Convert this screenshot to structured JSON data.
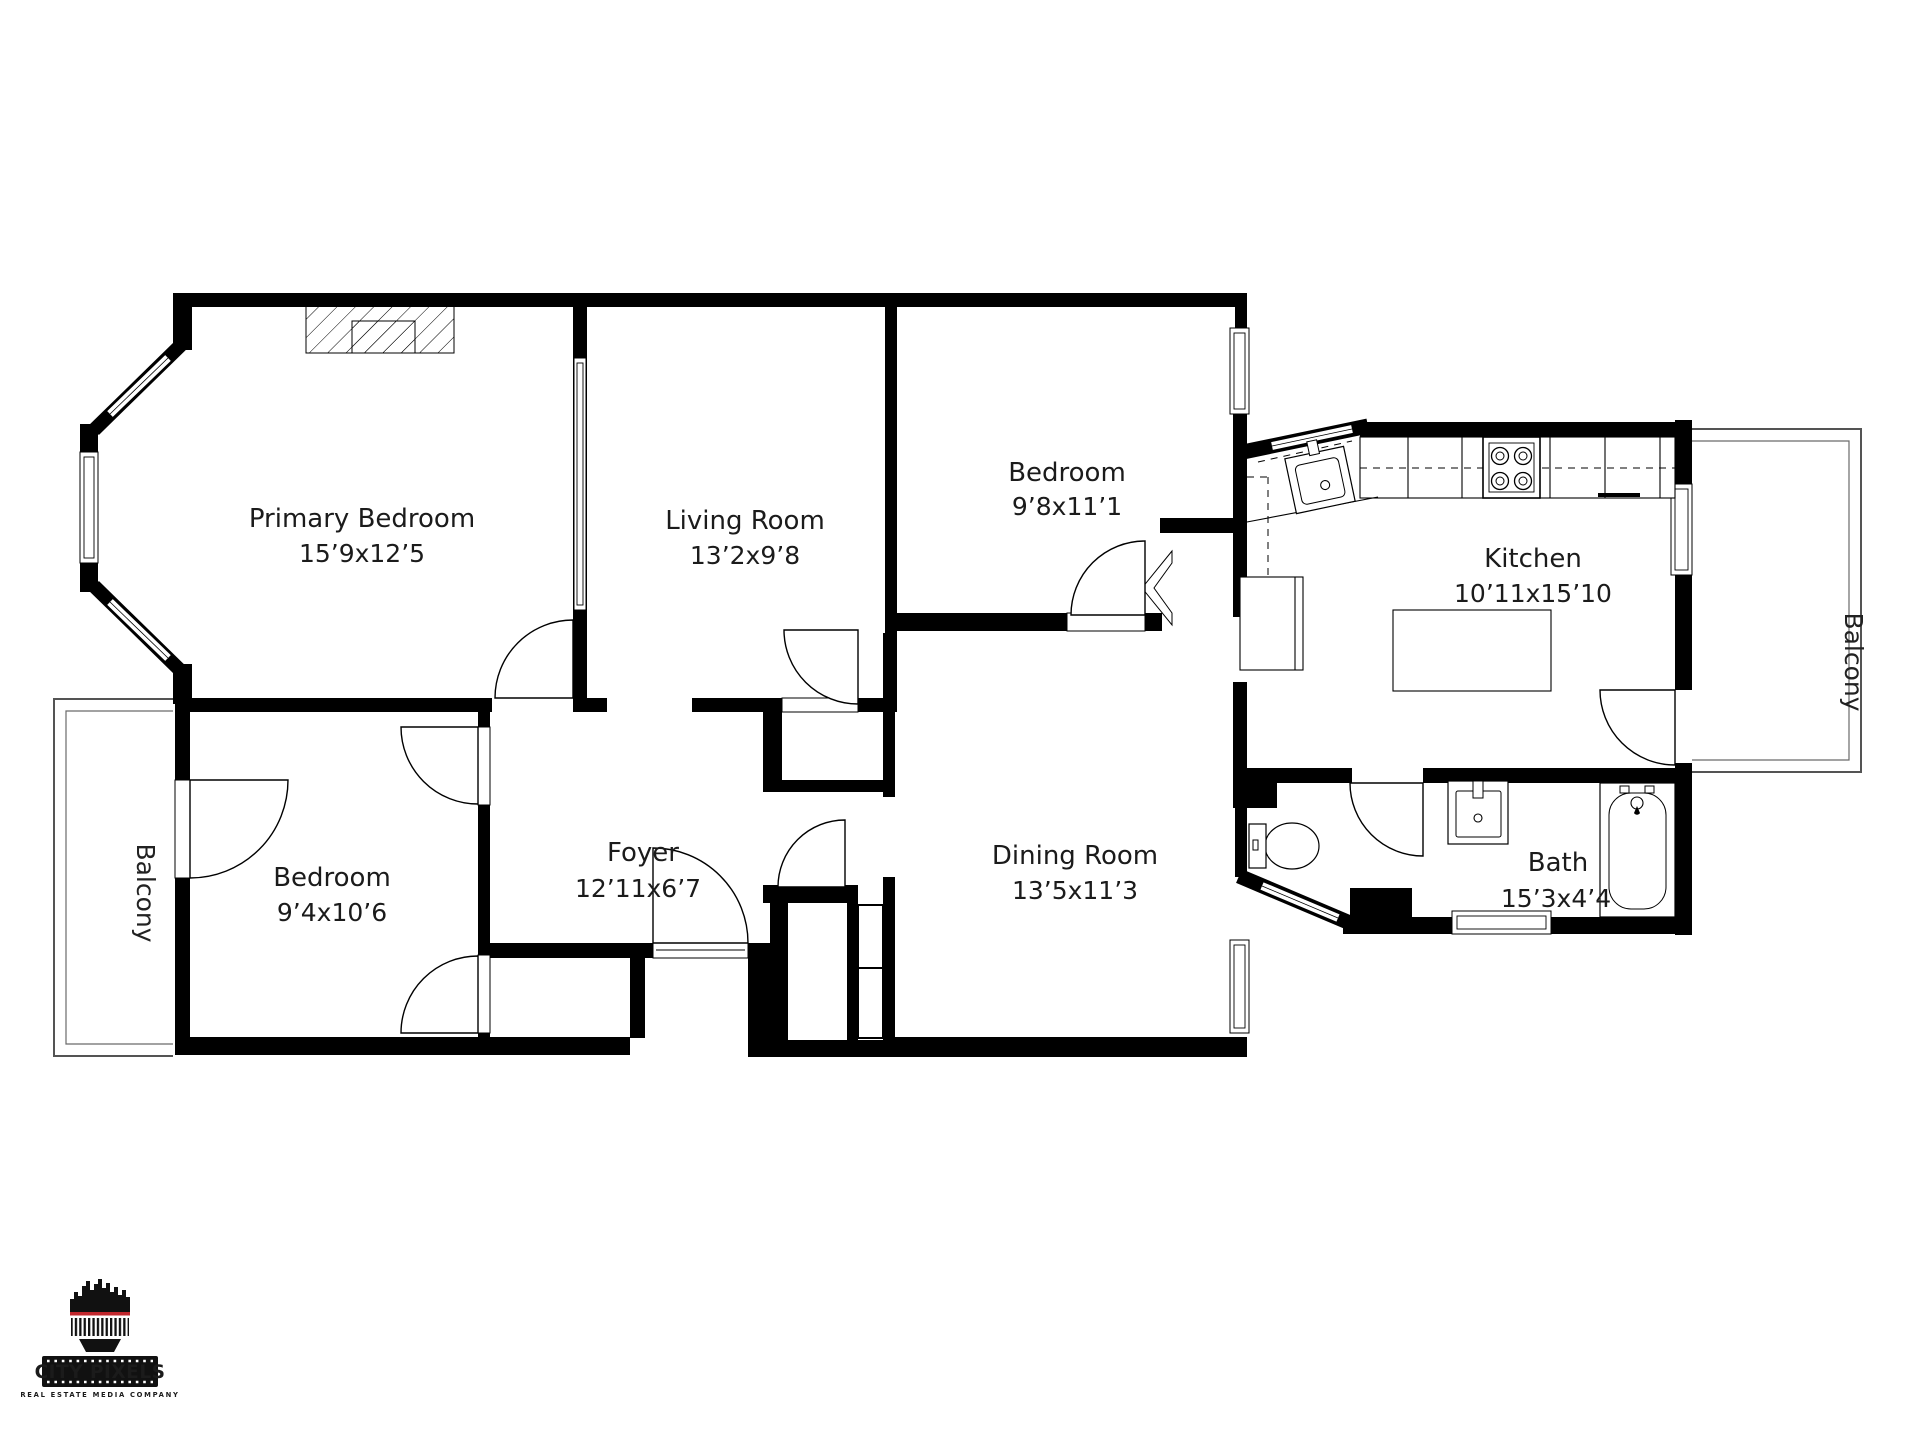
{
  "plan": {
    "rooms": [
      {
        "name": "Primary Bedroom",
        "dims": "15’9x12’5"
      },
      {
        "name": "Living Room",
        "dims": "13’2x9’8"
      },
      {
        "name": "Bedroom",
        "dims": "9’8x11’1"
      },
      {
        "name": "Kitchen",
        "dims": "10’11x15’10"
      },
      {
        "name": "Dining Room",
        "dims": "13’5x11’3"
      },
      {
        "name": "Bedroom",
        "dims": "9’4x10’6"
      },
      {
        "name": "Foyer",
        "dims": "12’11x6’7"
      },
      {
        "name": "Bath",
        "dims": "15’3x4’4"
      }
    ],
    "balconies": [
      {
        "name": "Balcony"
      },
      {
        "name": "Balcony"
      }
    ]
  },
  "logo": {
    "name": "CITY PIXELS",
    "tagline": "REAL ESTATE MEDIA COMPANY"
  },
  "colors": {
    "wall": "#000000",
    "background": "#ffffff",
    "label": "#1b1b1b",
    "logo_red": "#c1272d"
  }
}
